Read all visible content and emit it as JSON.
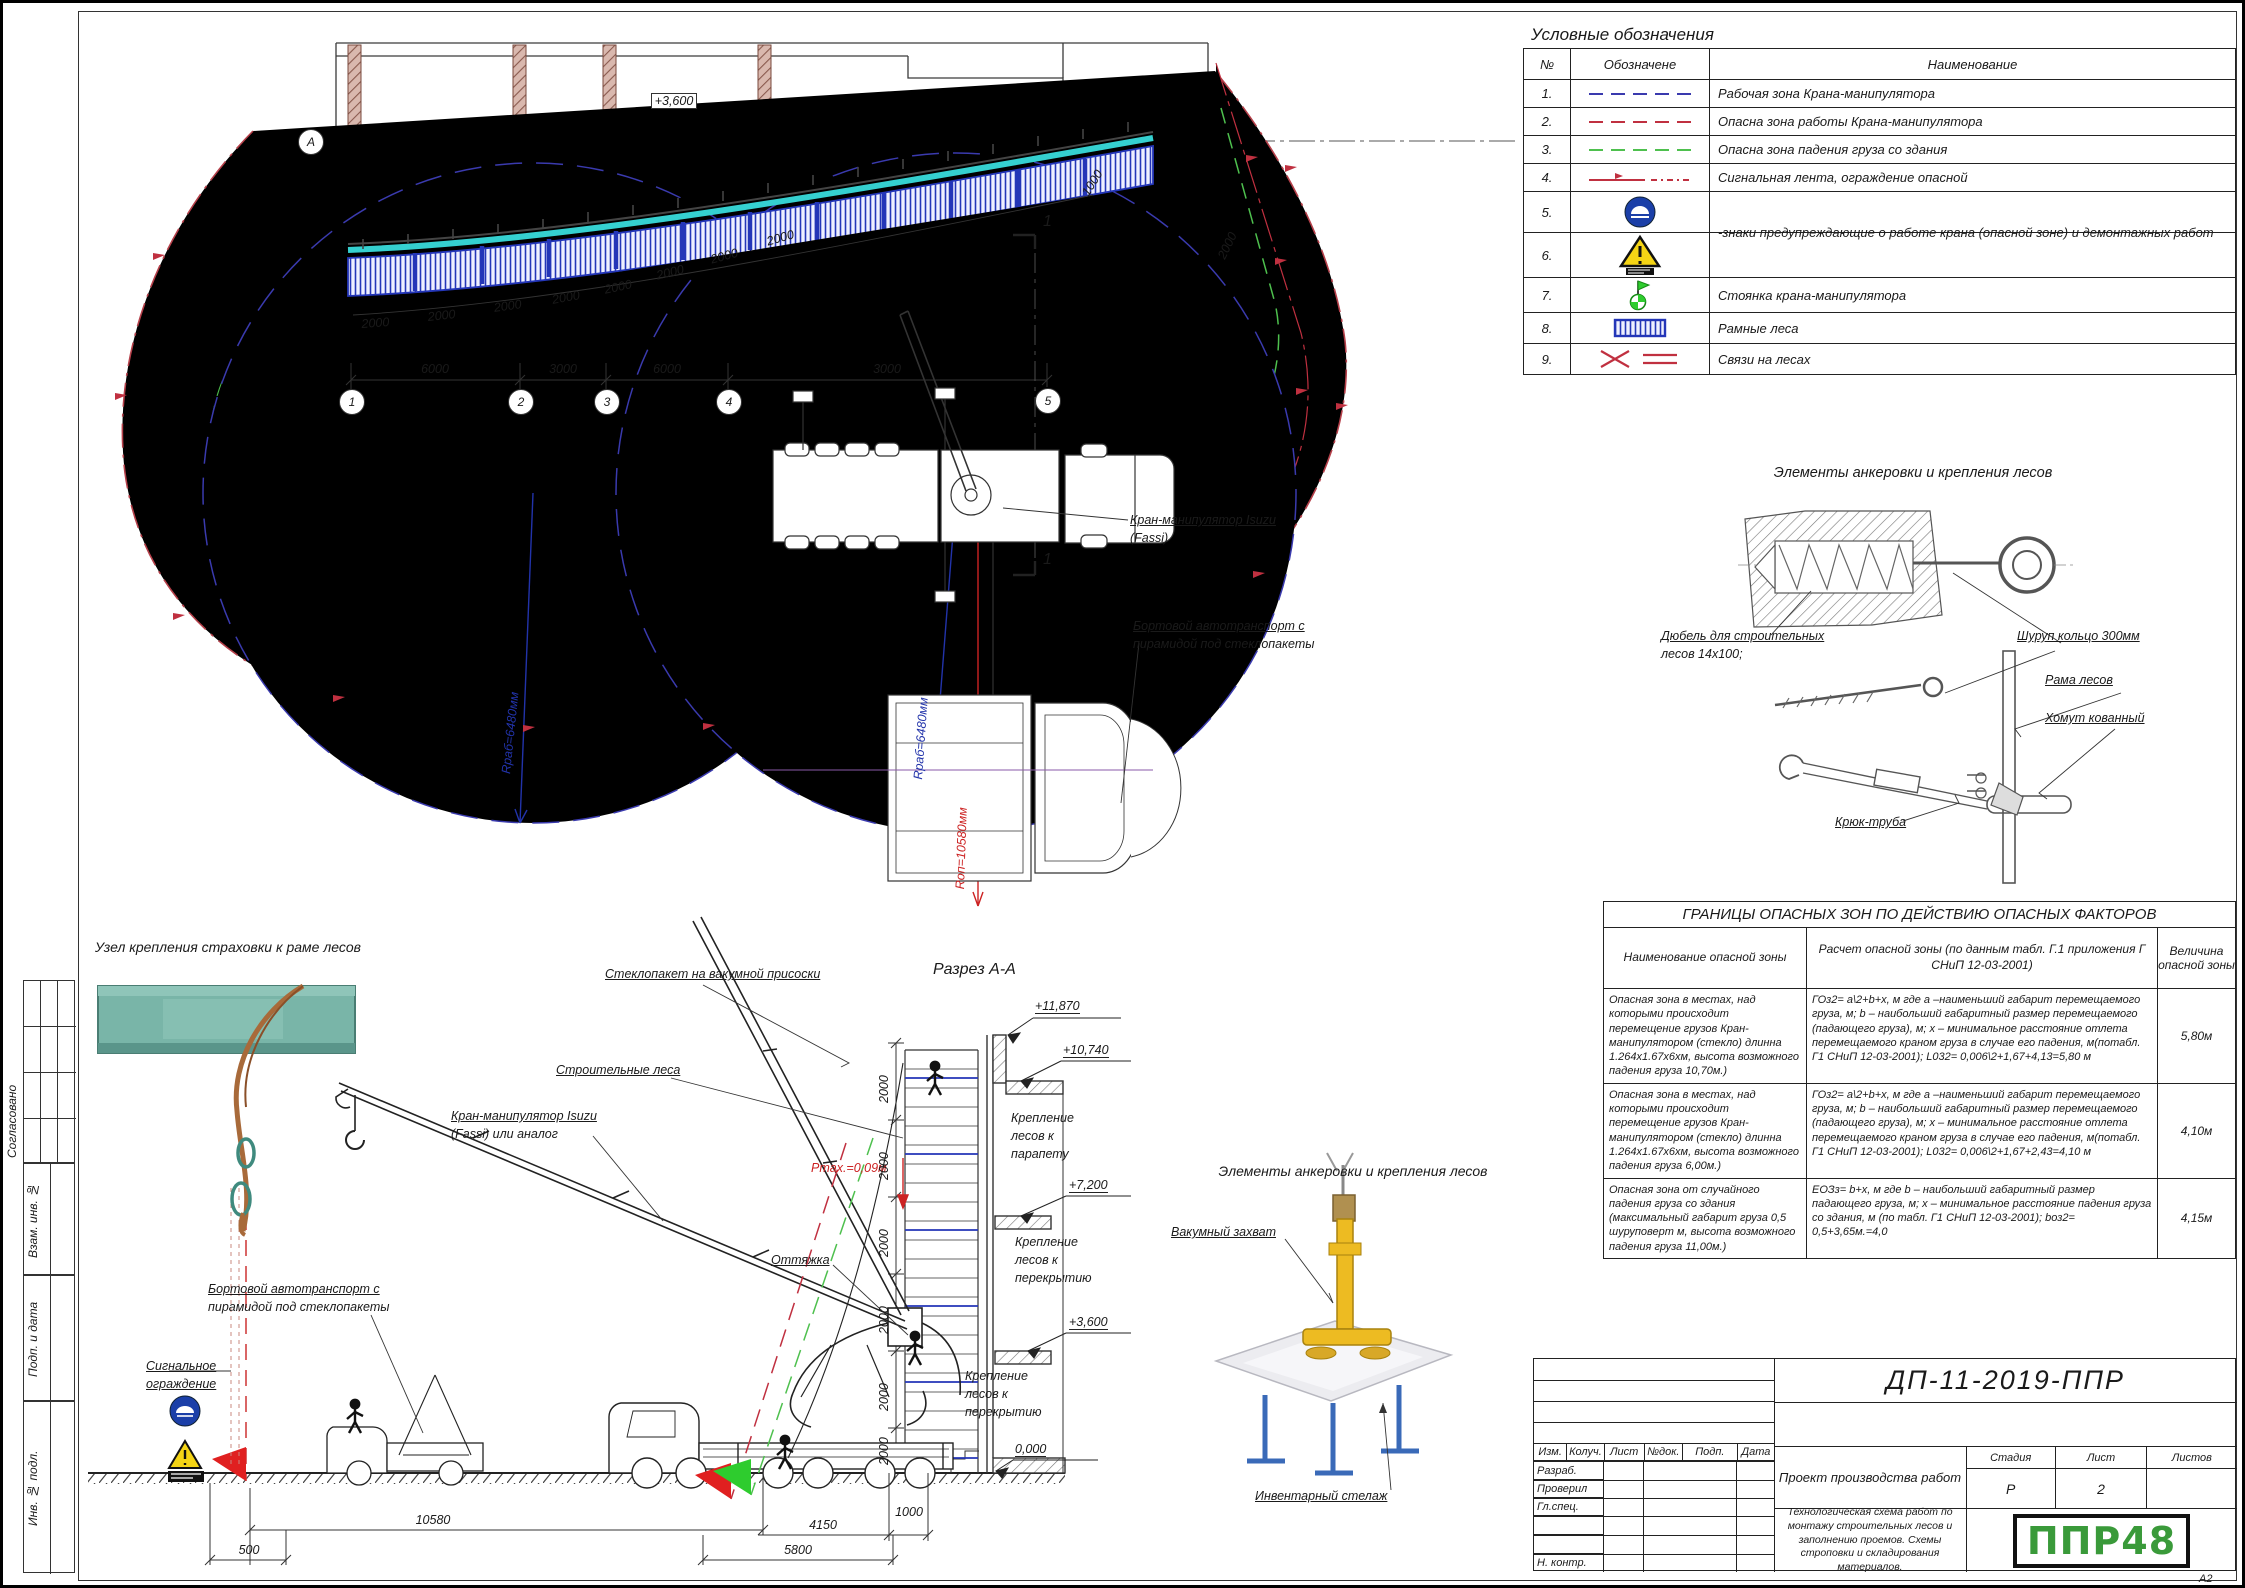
{
  "sheet": {
    "code": "ДП-11-2019-ППР",
    "doc_type": "Проект производства работ",
    "doc_title": "Технологическая схема работ по монтажу строительных лесов и заполнению проемов. Схемы строповки и складирования материалов.",
    "stage_label": "Стадия",
    "sheet_label": "Лист",
    "sheets_label": "Листов",
    "stage": "Р",
    "sheet_no": "2",
    "logo": "ППР48",
    "format": "А2",
    "cols": {
      "izm": "Изм.",
      "kol": "Колуч.",
      "list": "Лист",
      "ndok": "№док.",
      "podp": "Подп.",
      "data": "Дата"
    },
    "rows": {
      "razrab": "Разраб.",
      "proveril": "Проверил",
      "glspec": "Гл.спец.",
      "nkontr": "Н. контр."
    },
    "side": {
      "sogl": "Согласовано",
      "vzam": "Взам. инв. №",
      "podp": "Подп. и дата",
      "inv": "Инв. № подл."
    }
  },
  "legend": {
    "title": "Условные обозначения",
    "col_num": "№",
    "col_sym": "Обозначене",
    "col_name": "Наименование",
    "rows": [
      {
        "num": "1.",
        "name": "Рабочая зона Крана-манипулятора"
      },
      {
        "num": "2.",
        "name": "Опасна зона работы Крана-манипулятора"
      },
      {
        "num": "3.",
        "name": "Опасна зона падения груза со здания"
      },
      {
        "num": "4.",
        "name": "Сигнальная лента, ограждение опасной"
      },
      {
        "num": "5.",
        "name": "-знаки предупреждающие о работе крана (опасной зоне) и демонтажных работ"
      },
      {
        "num": "6.",
        "name": ""
      },
      {
        "num": "7.",
        "name": "Стоянка крана-манипулятора"
      },
      {
        "num": "8.",
        "name": "Рамные леса"
      },
      {
        "num": "9.",
        "name": "Связи на лесах"
      }
    ]
  },
  "anchor": {
    "title": "Элементы анкеровки и крепления лесов",
    "dowel1": "Дюбель для строительных",
    "dowel2": "лесов 14х100;",
    "screw_ring": "Шуруп кольцо 300мм",
    "frame": "Рама лесов",
    "clamp": "Хомут кованный",
    "hook_pipe": "Крюк-труба"
  },
  "danger": {
    "title": "ГРАНИЦЫ ОПАСНЫХ ЗОН ПО ДЕЙСТВИЮ ОПАСНЫХ ФАКТОРОВ",
    "col1": "Наименование опасной зоны",
    "col2": "Расчет опасной зоны (по данным табл. Г.1 приложения Г СНиП 12-03-2001)",
    "col3": "Величина опасной зоны",
    "rows": [
      {
        "name": "Опасная зона в местах, над которыми происходит перемещение грузов Кран-манипулятором (стекло)  длинна 1.264х1.67х6хм, высота возможного падения груза 10,70м.)",
        "calc": "ГОз2= а\\2+b+х, м  где а –наименьший габарит перемещаемого груза, м; b – наибольший габаритный размер перемещаемого (падающего груза), м; х – минимальное расстояние отлета перемещаемого краном груза в случае его падения, м(потабл. Г1 СНиП 12-03-2001); L032= 0,006\\2+1,67+4,13=5,80 м",
        "value": "5,80м"
      },
      {
        "name": "Опасная зона в местах, над которыми происходит перемещение грузов Кран-манипулятором (стекло)  длинна 1.264х1.67х6хм, высота возможного падения груза 6,00м.)",
        "calc": "ГОз2= а\\2+b+х, м  где а –наименьший габарит перемещаемого груза, м; b – наибольший габаритный размер перемещаемого (падающего груза), м; х – минимальное расстояние отлета перемещаемого краном груза в случае его падения, м(потабл. Г1 СНиП 12-03-2001); L032= 0,006\\2+1,67+2,43=4,10 м",
        "value": "4,10м"
      },
      {
        "name": "Опасная зона от случайного падения груза со здания (максимальный габарит груза 0,5 шуруповерт м, высота возможного падения груза 11,00м.)",
        "calc": "ЕОЗз= b+х, м  где b – наибольший габаритный размер падающего груза, м; х – минимальное расстояние падения груза со здания, м (по табл. Г1 СНиП 12-03-2001); bоз2= 0,5+3,65м.=4,0",
        "value": "4,15м"
      }
    ]
  },
  "plan": {
    "axis": "А",
    "level": "+3,600",
    "b1": "1",
    "b2": "2",
    "b3": "3",
    "b4": "4",
    "b5": "5",
    "d6000": "6000",
    "d3000": "3000",
    "d2000": "2000",
    "d1000": "1000",
    "crane1": "Кран-манипулятор Isuzu",
    "crane2": "(Fassi)",
    "truck1": "Бортовой автотранспорт с",
    "truck2": "пирамидой под стеклопакеты",
    "rwork": "Rраб=6480мм",
    "rdanger": "Rоп=10580мм",
    "cut": "1"
  },
  "section": {
    "title": "Разрез А-А",
    "node_title": "Узел крепления страховки к раме лесов",
    "glass": "Стеклопакет на вакумной присоски",
    "scaffold": "Строительные леса",
    "crane1": "Кран-манипулятор Isuzu",
    "crane2": "(Fassi) или аналог",
    "guy": "Оттяжка",
    "pmax": "Pmax.=0,09м",
    "truck1": "Бортовой автотранспорт с",
    "truck2": "пирамидой под стеклопакеты",
    "signal1": "Сигнальное",
    "signal2": "ограждение",
    "fix1": "Крепление",
    "fix2": "лесов к",
    "fix3a": "парапету",
    "fix3b": "перекрытию",
    "lv1": "+11,870",
    "lv2": "+10,740",
    "lv3": "+7,200",
    "lv4": "+3,600",
    "lv0": "0,000",
    "d2000": "2000",
    "d500": "500",
    "d10580": "10580",
    "d4150": "4150",
    "d1000": "1000",
    "d5800": "5800"
  },
  "vacuum": {
    "title": "Элементы анкеровки и крепления лесов",
    "grab": "Вакумный захват",
    "rack": "Инвентарный стелаж"
  }
}
